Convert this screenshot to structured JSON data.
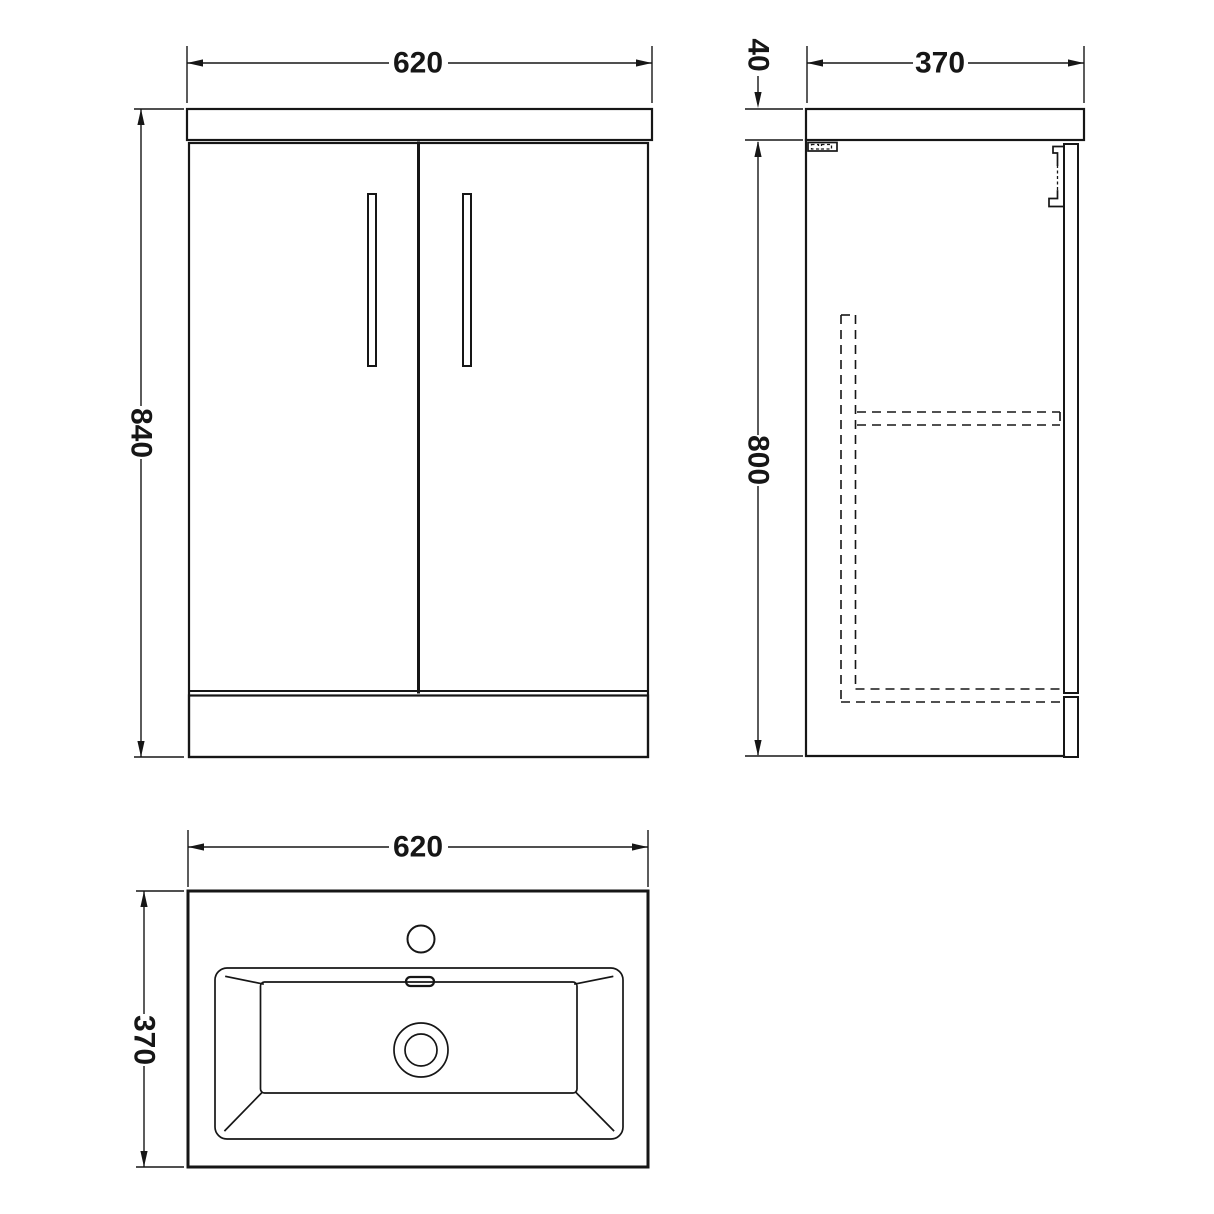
{
  "colors": {
    "background": "#ffffff",
    "line": "#161616"
  },
  "dimensions": {
    "front_width": "620",
    "front_height": "840",
    "counter_thickness": "40",
    "side_depth": "370",
    "side_height": "800",
    "basin_width": "620",
    "basin_depth": "370"
  }
}
